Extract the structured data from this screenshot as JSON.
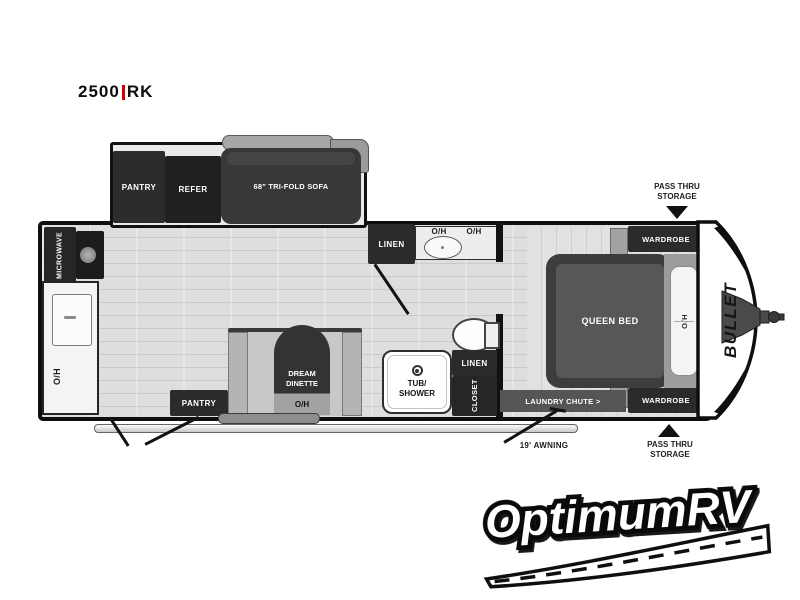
{
  "model": {
    "series": "2500",
    "trim": "RK"
  },
  "slideout": {
    "pantry": "PANTRY",
    "refer": "REFER",
    "sofa": "68\" TRI-FOLD SOFA"
  },
  "kitchen": {
    "microwave": "MICROWAVE",
    "overhead": "O/H"
  },
  "dinette": {
    "name1": "DREAM",
    "name2": "DINETTE",
    "overhead": "O/H",
    "pantry": "PANTRY"
  },
  "bath": {
    "linen_hall": "LINEN",
    "oh_left": "O/H",
    "oh_right": "O/H",
    "tub1": "TUB/",
    "tub2": "SHOWER",
    "linen": "LINEN",
    "closet": "CLOSET"
  },
  "bedroom": {
    "bed": "QUEEN BED",
    "overhead": "O/H",
    "wardrobe_top": "WARDROBE",
    "wardrobe_bottom": "WARDROBE",
    "laundry": "LAUNDRY CHUTE >"
  },
  "exterior": {
    "pass_thru_line1": "PASS THRU",
    "pass_thru_line2": "STORAGE",
    "awning": "19' AWNING",
    "brand": "BULLET"
  },
  "logo": {
    "name": "OptimumRV"
  },
  "colors": {
    "wall": "#0f0f0f",
    "cabinet_dark": "#2b2b2b",
    "floor": "#dcdcdc",
    "divider_red": "#d40000",
    "band_gray": "#555555"
  }
}
